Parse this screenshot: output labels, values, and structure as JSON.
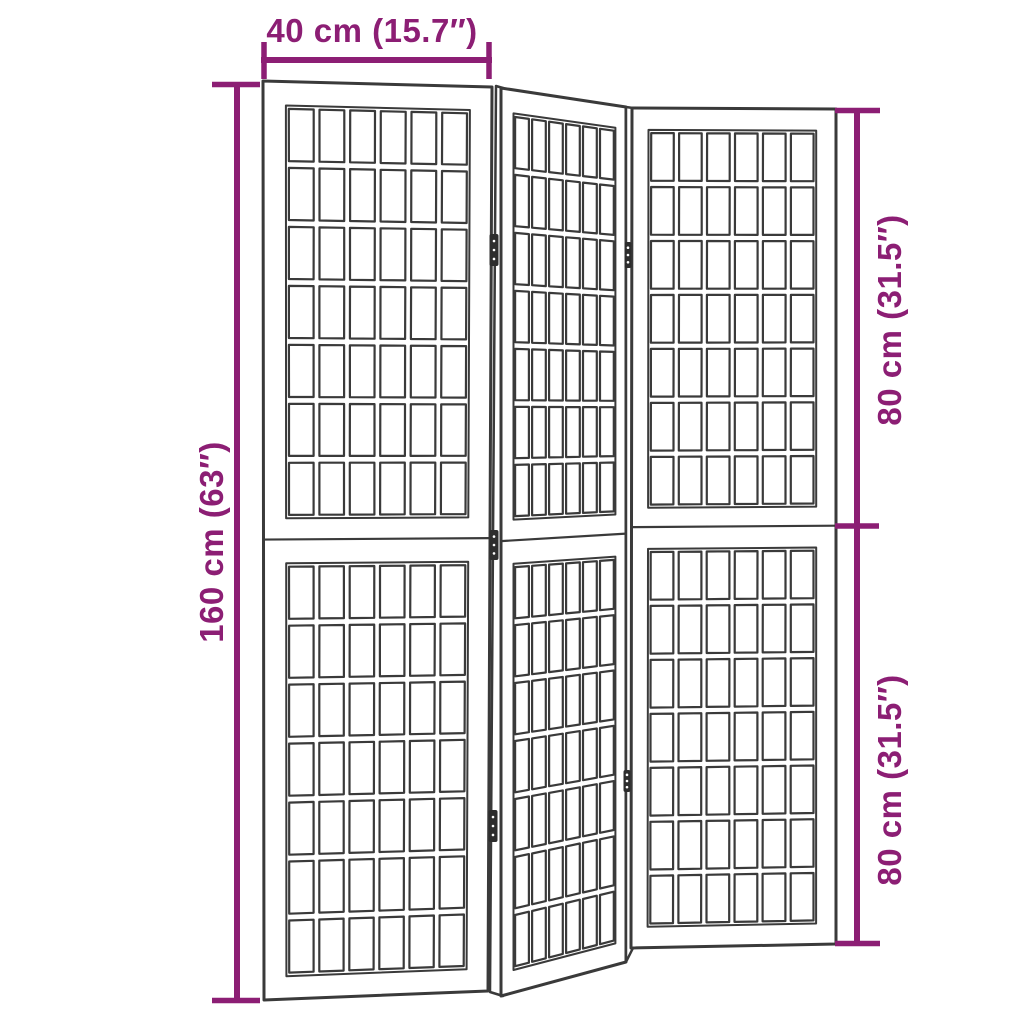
{
  "diagram": {
    "dimensions": {
      "width": "40 cm (15.7″)",
      "total_height": "160 cm (63″)",
      "upper_height": "80 cm (31.5″)",
      "lower_height": "80 cm (31.5″)"
    },
    "colors": {
      "dimension_accent": "#8C1E74",
      "line_art": "#3A3A3A",
      "background": "#FFFFFF"
    },
    "screen": {
      "panel_count": 3,
      "sections_per_panel": 2,
      "grid_columns_per_panel": 6,
      "grid_rows_per_section": 7,
      "hinge_count": 5
    }
  }
}
